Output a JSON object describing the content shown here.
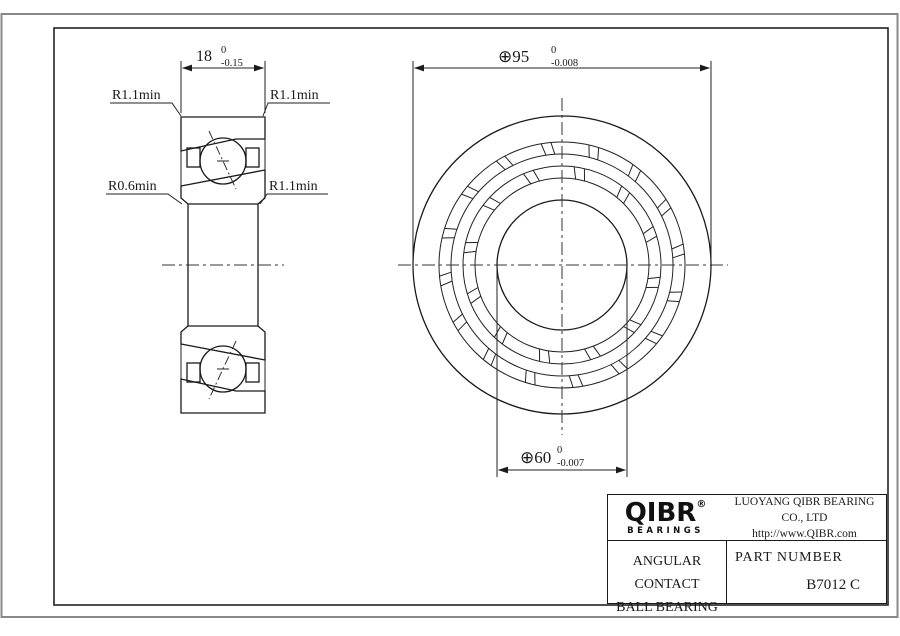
{
  "drawing": {
    "dim_width": {
      "value": "18",
      "tol_upper": "0",
      "tol_lower": "-0.15"
    },
    "dim_od": {
      "value": "⊕95",
      "tol_upper": "0",
      "tol_lower": "-0.008"
    },
    "dim_bore": {
      "value": "⊕60",
      "tol_upper": "0",
      "tol_lower": "-0.007"
    },
    "labels": {
      "top_left": "R1.1min",
      "top_right": "R1.1min",
      "bottom_left": "R0.6min",
      "mid_right": "R1.1min"
    }
  },
  "title_block": {
    "logo_text": "QIBR",
    "logo_registered": "®",
    "logo_subtext": "BEARINGS",
    "company": "LUOYANG QIBR BEARING CO., LTD",
    "website": "http://www.QIBR.com",
    "product_line1": "ANGULAR CONTACT",
    "product_line2": "BALL BEARING",
    "part_number_label": "PART NUMBER",
    "part_number": "B7012 C"
  },
  "colors": {
    "line": "#1a1a1a",
    "outer_border": "#888888",
    "background": "#ffffff"
  }
}
